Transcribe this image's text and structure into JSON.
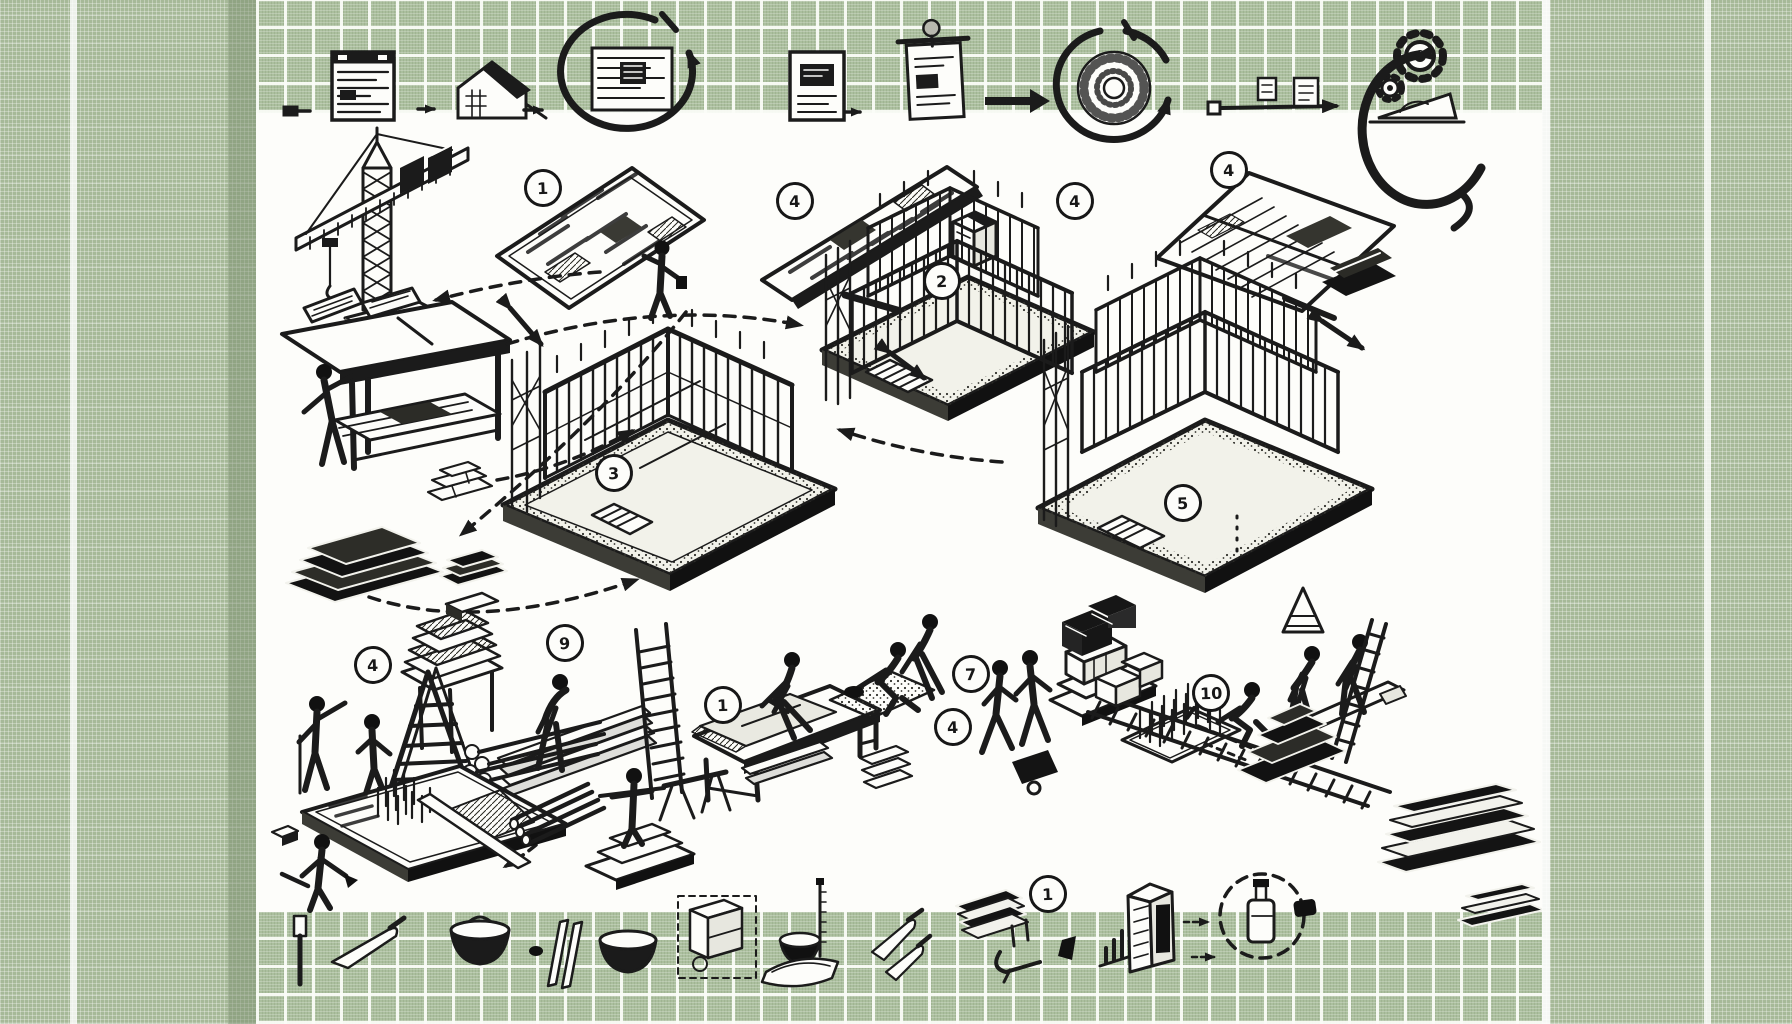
{
  "title": "Hand-drawn building construction process diagram on green woven backdrop",
  "style": {
    "border_green": "#a6b998",
    "tile_green": "#abbf9e",
    "grid_line": "#f6f8f3",
    "ink": "#1b1b1b",
    "paper": "#fdfdfa"
  },
  "markers": [
    {
      "id": 1,
      "label": "1",
      "near": "site-plan-sheet"
    },
    {
      "id": 2,
      "label": "4",
      "near": "strip-plan-left"
    },
    {
      "id": 3,
      "label": "2",
      "near": "materials-box"
    },
    {
      "id": 4,
      "label": "4",
      "near": "frame-building-stage-2"
    },
    {
      "id": 5,
      "label": "4",
      "near": "open-plan-booklet"
    },
    {
      "id": 6,
      "label": "3",
      "near": "frame-building-stage-1"
    },
    {
      "id": 7,
      "label": "5",
      "near": "frame-building-stage-3"
    },
    {
      "id": 8,
      "label": "4",
      "near": "workers-discussing"
    },
    {
      "id": 9,
      "label": "9",
      "near": "stacked-sheets"
    },
    {
      "id": 10,
      "label": "1",
      "near": "sawing-bench"
    },
    {
      "id": 11,
      "label": "7",
      "near": "mortar-workers"
    },
    {
      "id": 12,
      "label": "4",
      "near": "mortar-workers"
    },
    {
      "id": 13,
      "label": "10",
      "near": "rebar-mat",
      "style": "magnifier"
    },
    {
      "id": 14,
      "label": "1",
      "near": "sheet-stack-press"
    }
  ],
  "top_strip": {
    "icons": [
      {
        "name": "connector-plug-icon"
      },
      {
        "name": "blueprint-poster-icon"
      },
      {
        "name": "small-arrow-icon"
      },
      {
        "name": "house-sketch-icon"
      },
      {
        "name": "small-arrow-icon"
      },
      {
        "name": "cycle-loop-blueprint-icon"
      },
      {
        "name": "framed-plan-icon"
      },
      {
        "name": "small-arrow-icon"
      },
      {
        "name": "pinned-sheet-icon"
      },
      {
        "name": "thick-arrow-icon"
      },
      {
        "name": "cycle-loop-seal-icon"
      },
      {
        "name": "small-card-icon"
      },
      {
        "name": "long-arrow-icon"
      },
      {
        "name": "small-frame-icon"
      },
      {
        "name": "gear-pair-icon"
      },
      {
        "name": "compass-loop-setsquare-icon"
      }
    ]
  },
  "bottom_strip": {
    "icons": [
      {
        "name": "chisel-icon"
      },
      {
        "name": "trowel-icon"
      },
      {
        "name": "mortar-bowl-icon"
      },
      {
        "name": "leaning-planks-icon"
      },
      {
        "name": "mortar-bowl-icon"
      },
      {
        "name": "cabinet-sketch-icon"
      },
      {
        "name": "small-bowl-icon"
      },
      {
        "name": "tray-icon"
      },
      {
        "name": "measuring-rod-icon"
      },
      {
        "name": "trowel-pair-icon"
      },
      {
        "name": "sheet-stack-press-icon"
      },
      {
        "name": "clamp-icon"
      },
      {
        "name": "wedge-icon"
      },
      {
        "name": "bar-frame-icon"
      },
      {
        "name": "formwork-booth-icon"
      },
      {
        "name": "dashed-arrow-icon"
      },
      {
        "name": "inspection-circle-bottle-icon"
      },
      {
        "name": "sponge-block-icon"
      },
      {
        "name": "slab-stack-icon"
      }
    ]
  },
  "scene": {
    "vignettes": [
      {
        "name": "tower-crane",
        "desc": "tower crane with lattice mast and counterweights"
      },
      {
        "name": "site-plan-sheet",
        "desc": "isometric blueprint sheet studied by a figure"
      },
      {
        "name": "drafting-desk",
        "desc": "desk with open plan book and drafter"
      },
      {
        "name": "paper-stacks",
        "desc": "layered stacks of drawings"
      },
      {
        "name": "strip-plan",
        "desc": "long narrow plan board with pen and box"
      },
      {
        "name": "frame-building-stage-1",
        "desc": "single-storey timber frame on stippled pad"
      },
      {
        "name": "frame-building-stage-2",
        "desc": "two-storey frame with scaffolding and stairs"
      },
      {
        "name": "frame-building-stage-3",
        "desc": "long two-storey frame with scaffolding"
      },
      {
        "name": "open-plan-booklet",
        "desc": "open construction booklet with stapler and pen"
      },
      {
        "name": "workers-discussing",
        "desc": "two workers talking, one holding a rod"
      },
      {
        "name": "stepladder-and-sheet-table",
        "desc": "A-frame ladder before stacked sheets on a stand"
      },
      {
        "name": "lumber-stack-worker",
        "desc": "worker bent over plank and log pile"
      },
      {
        "name": "straight-ladder",
        "desc": "tall straight ladder"
      },
      {
        "name": "sawing-bench-worker",
        "desc": "worker sawing sheet material on a bench"
      },
      {
        "name": "mortar-workers",
        "desc": "workers spreading mortar on a low pad"
      },
      {
        "name": "walking-workers",
        "desc": "two workers walking with cart"
      },
      {
        "name": "block-stack",
        "desc": "concrete blocks stacked on stepped pedestal"
      },
      {
        "name": "rebar-mat",
        "desc": "pad with upright rebar spikes"
      },
      {
        "name": "kneeling-measuring-worker",
        "desc": "kneeling worker by dashed layout line"
      },
      {
        "name": "beam-lifting-workers",
        "desc": "two workers lifting a long beam"
      },
      {
        "name": "leaning-ladder",
        "desc": "ladder leaning at building base"
      },
      {
        "name": "conveyor-track",
        "desc": "long track with cross ties and bricks"
      },
      {
        "name": "step-pyramid-stack",
        "desc": "stepped stack of slabs"
      },
      {
        "name": "foundation-pad",
        "desc": "foundation pad with rebar, plank and trowel worker"
      },
      {
        "name": "pipe-bundle",
        "desc": "bundle of pipes/rods"
      },
      {
        "name": "pedestal-worker",
        "desc": "figure standing on stepped pedestal holding a level"
      },
      {
        "name": "trestle",
        "desc": "small site trestle stand"
      },
      {
        "name": "process-arrows",
        "desc": "dashed arcs and double-headed arrows linking stages"
      }
    ]
  }
}
